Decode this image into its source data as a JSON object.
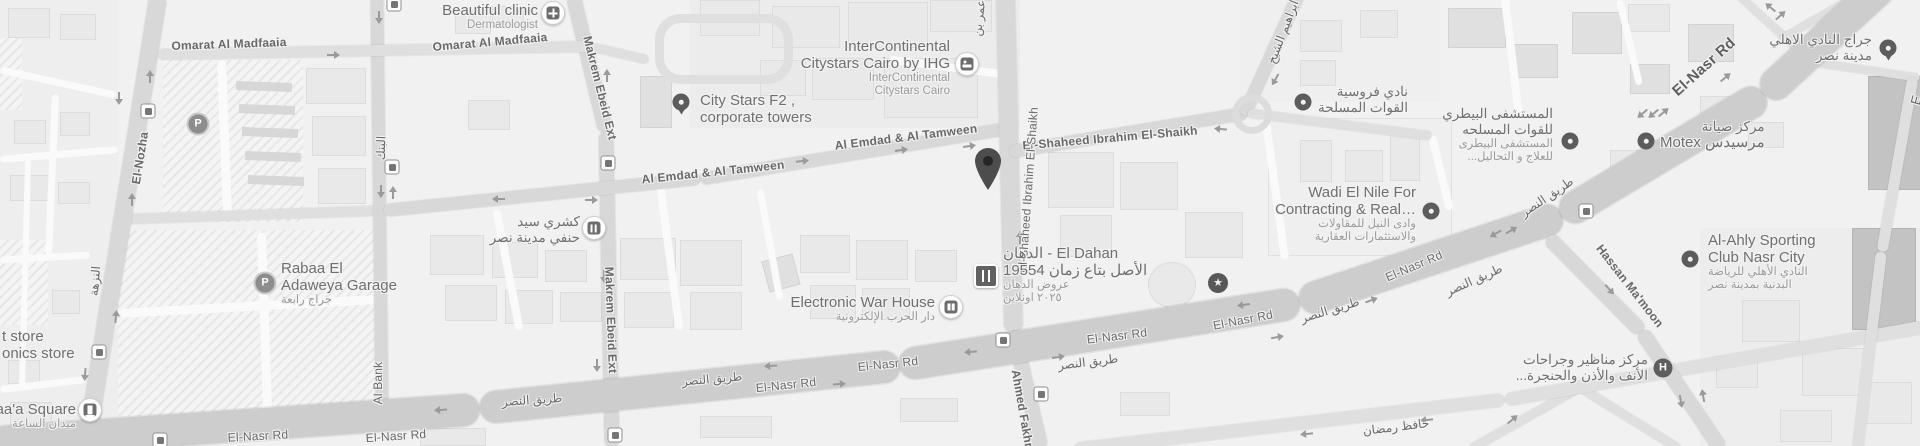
{
  "colors": {
    "background": "#f1f1f1",
    "road": "#dfdfdf",
    "highway": "#cdcdcd",
    "road_label": "#696969",
    "poi_label": "#6f6f6f",
    "poi_sublabel": "#9b9b9b",
    "icon_dark": "#5c5c5c",
    "marker": "#4d4d4d"
  },
  "roads": {
    "omarat": "Omarat Al Madfaaia",
    "el_nozha_en": "El-Nozha",
    "el_nozha_ar": "النزهة",
    "al_bank_en": "Al Bank",
    "al_bank_ar": "البنك",
    "makrem": "Makrem Ebeid Ext",
    "al_emdad": "Al Emdad & Al Tamween",
    "shaheed": "El-Shaheed Ibrahim El-Shaikh",
    "ibrahim_ar": "ابراهيم الشيخ",
    "omar_ar": "عمر بن",
    "ahmed_fakhry": "Ahmed Fakhry",
    "el_nasr_en": "El-Nasr Rd",
    "el_nasr_ar": "طريق النصر",
    "hafez_ar": "حافظ رمضان",
    "hassan": "Hassan Ma'moon",
    "partial_e": "E"
  },
  "pois": {
    "beautiful_clinic": {
      "name": "Beautiful clinic",
      "sub": "Dermatologist"
    },
    "city_stars": {
      "l1": "City Stars F2 ,",
      "l2": "corporate towers"
    },
    "intercontinental": {
      "l1": "InterContinental",
      "l2": "Citystars Cairo by IHG",
      "s1": "InterContinental",
      "s2": "Citystars Cairo"
    },
    "koshary": {
      "l1": "كشري سيد",
      "l2": "حنفي مدينة نصر"
    },
    "electronic_war": {
      "name": "Electronic War House",
      "sub": "دار الحرب الإلكترونية"
    },
    "el_dahan": {
      "l1": "الدهان - El Dahan",
      "l2": "الأصل بتاع زمان 19554",
      "s1": "عروض الدهان",
      "s2": "٢٠٢٥ اونلاين"
    },
    "forosya": {
      "l1": "نادي فروسية",
      "l2": "القوات المسلحة"
    },
    "wadi_el_nile": {
      "l1": "Wadi El Nile For",
      "l2": "Contracting & Real…",
      "s1": "وادى النيل للمقاولات",
      "s2": "والاستثمارات العقارية"
    },
    "vet_hospital": {
      "l1": "المستشفى البيطري",
      "l2": "للقوات المسلحه",
      "s1": "المستشفى البيطرى",
      "s2": "للعلاج و التحاليل..."
    },
    "motex": {
      "l1": "مركز صيانة",
      "l2": "مرسيدس Motex"
    },
    "ahly_garage": {
      "l1": "جراج النادي الاهلي",
      "l2": "مدينة نصر"
    },
    "ahly_club": {
      "l1": "Al-Ahly Sporting",
      "l2": "Club Nasr City",
      "s1": "النادي الأهلي للرياضة",
      "s2": "البدنية بمدينة نصر"
    },
    "ent_center": {
      "l1": "مركز مناظير وجراحات",
      "l2": "الأنف والأذن والحنجرة..."
    },
    "rabaa_garage": {
      "l1": "Rabaa El",
      "l2": "Adaweya Garage",
      "sub": "جراج رابعة"
    },
    "saa_square": {
      "name": "Saa'a Square",
      "sub": "ميدان الساعة"
    },
    "store_partial_1": "t store",
    "store_partial_2": "onics store"
  },
  "glyphs": {
    "parking": "P",
    "hospital": "H",
    "star": "★"
  }
}
